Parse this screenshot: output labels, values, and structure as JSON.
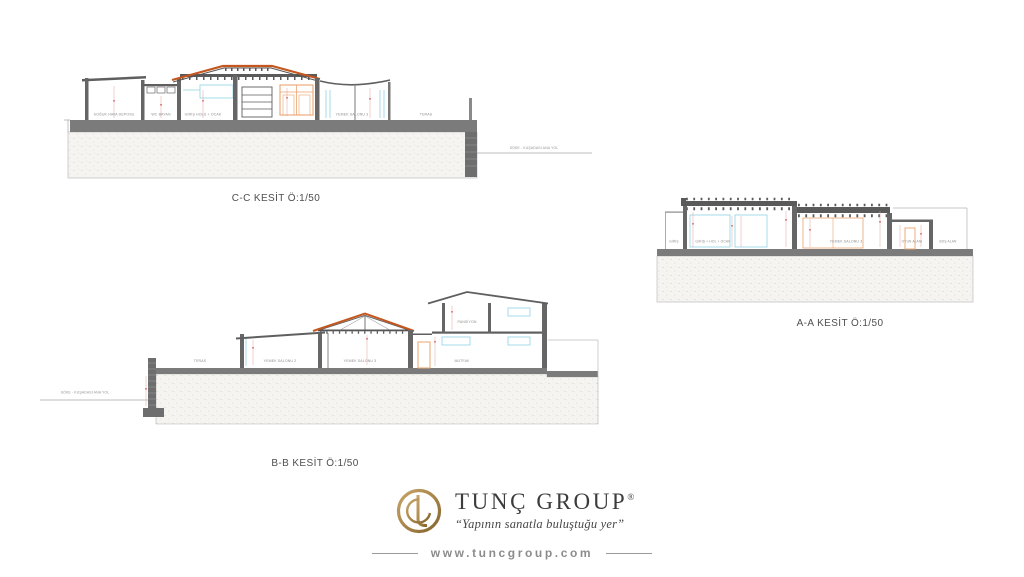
{
  "sections": {
    "cc": {
      "title": "C-C KESİT Ö:1/50",
      "road_label": "SÖKE - KUŞADASI ANA YOL",
      "rooms": {
        "soguk_hava": "SOĞUK HAVA DEPOSU",
        "wc_bayan": "WC BAYAN",
        "giris_hol": "GİRİŞ HOLÜ + OCAK",
        "yemek3": "YEMEK SALONU 3",
        "teras": "TERAS"
      }
    },
    "bb": {
      "title": "B-B KESİT Ö:1/50",
      "road_label": "SÖKE - KUŞADASI ANA YOL",
      "rooms": {
        "teras": "TERAS",
        "yemek2": "YEMEK SALONU 2",
        "yemek3": "YEMEK SALONU 3",
        "mutfak": "MUTFAK",
        "pansiyon": "PANSİYON"
      }
    },
    "aa": {
      "title": "A-A KESİT Ö:1/50",
      "rooms": {
        "giris": "GİRİŞ",
        "giris_hol": "GİRİŞ + HOL + OCAK",
        "yemek3": "YEMEK SALONU 3",
        "oyun": "OYUN ALANI",
        "bos": "BOŞ ALAN"
      }
    }
  },
  "footer": {
    "brand": "TUNÇ GROUP",
    "registered": "®",
    "tagline": "“Yapının sanatla buluştuğu yer”",
    "website": "www.tuncgroup.com"
  },
  "colors": {
    "wall_gray": "#666666",
    "slab_gray": "#7b7b7b",
    "beam_gray": "#5a5a5a",
    "roof_orange": "#c4571f",
    "glass_cyan": "#8fd2e2",
    "door_orange": "#eba36e",
    "dim_red": "#e2a0a0",
    "dim_mark_red": "#d96a6a",
    "soil_fill": "#f5f4f1",
    "logo_gold": "#a9854a",
    "text_gray": "#8d8d8d"
  }
}
